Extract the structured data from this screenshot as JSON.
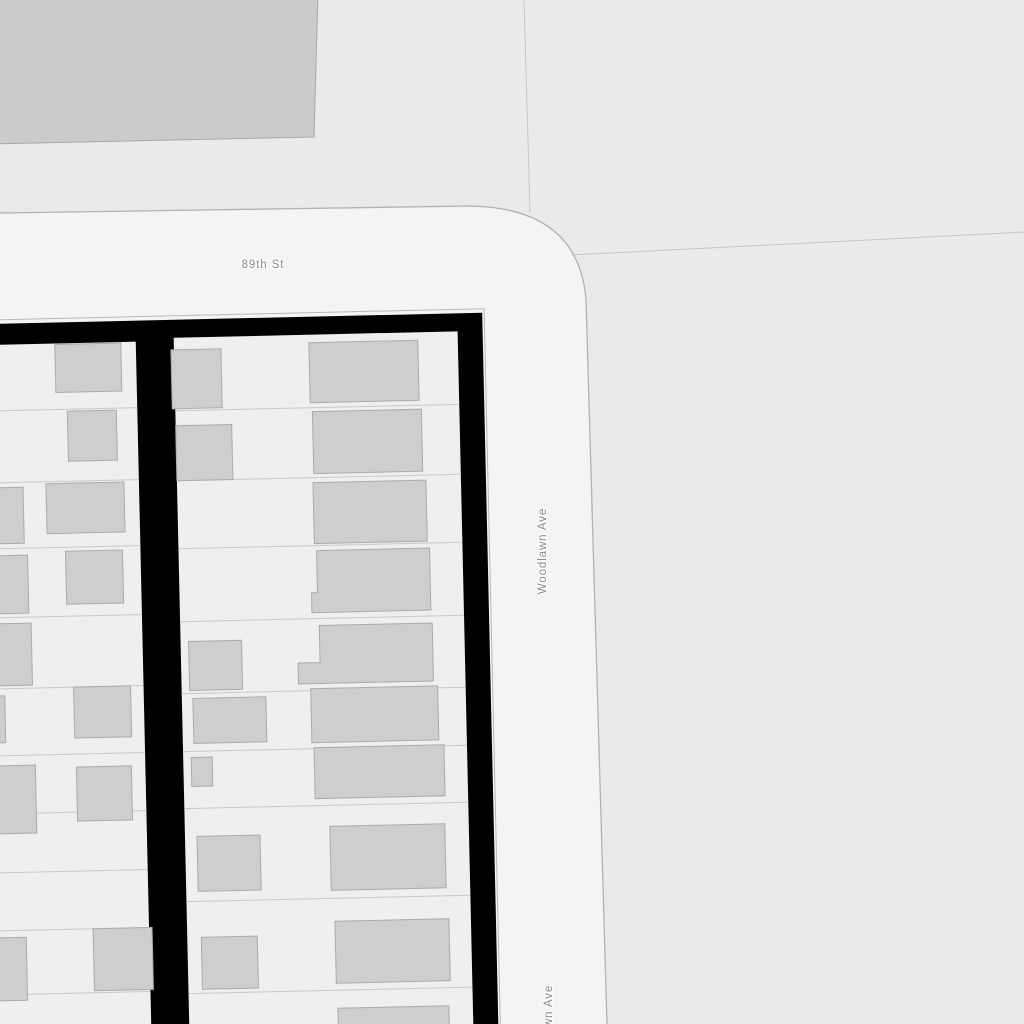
{
  "map": {
    "type": "street-map-viewport",
    "labels": {
      "street": "89th St",
      "avenue": "Woodlawn Ave",
      "avenue_partial": "Woodlawn Ave"
    },
    "colors": {
      "background_blocks": "#eaeaea",
      "road_fill": "#f4f4f4",
      "road_edge_stroke": "#b2b2b2",
      "parcel_fill": "#efefef",
      "parcel_line_stroke": "#c9c9c9",
      "cadastral_line_stroke": "#c6c6c6",
      "building_fill": "#cecece",
      "building_stroke": "#ababab",
      "large_building_fill": "#cbcbcb",
      "block_boundary_highlight": "#000000",
      "label_text": "#8a8a8a"
    }
  }
}
